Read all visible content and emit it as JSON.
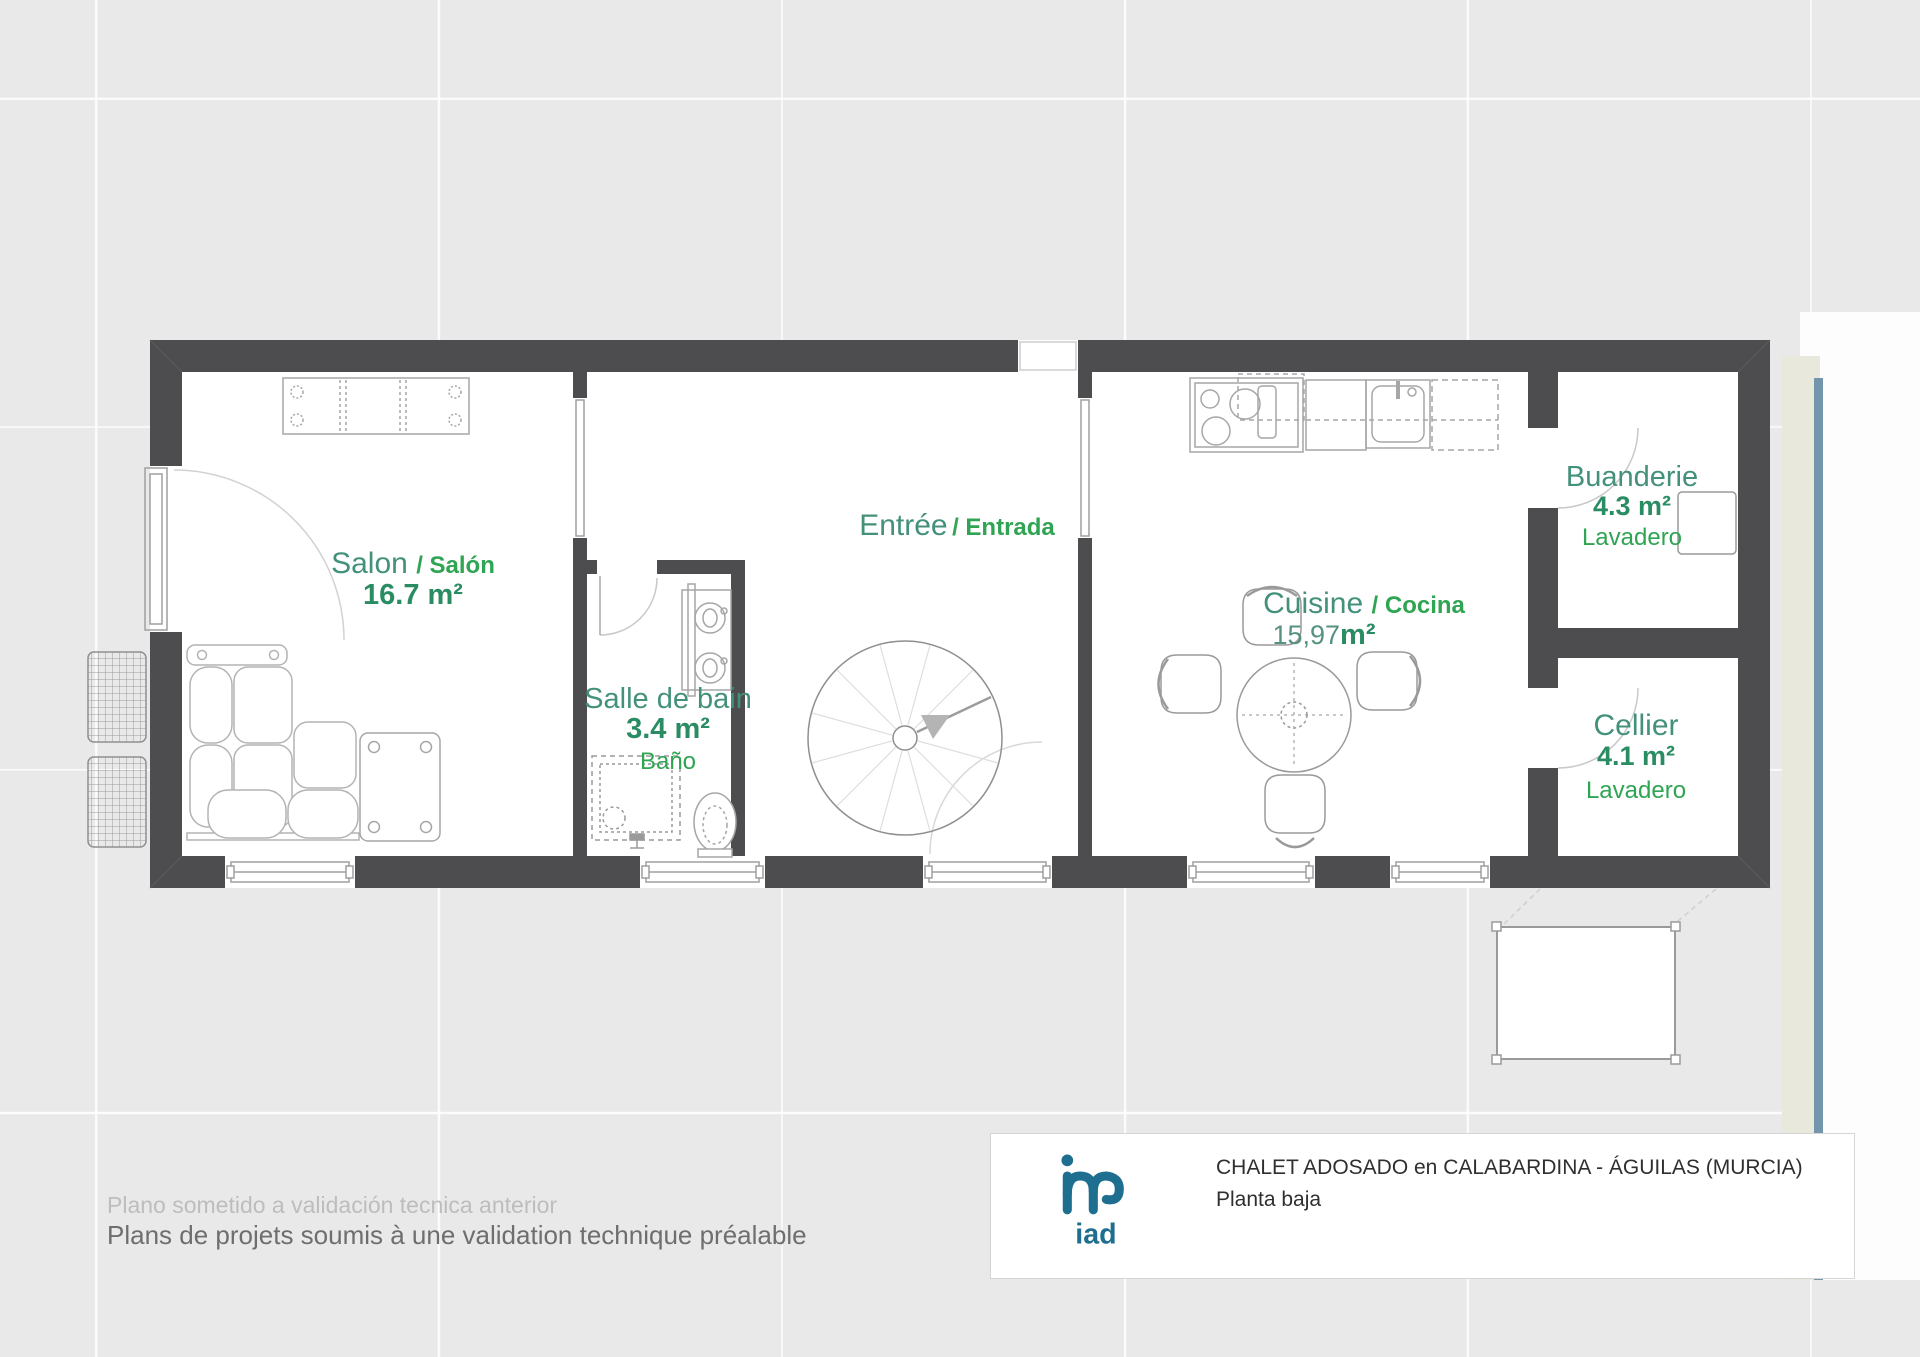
{
  "colors": {
    "wall": "#4d4d4f",
    "background": "#e9e9e9",
    "room_name": "#44917b",
    "room_name_alt": "#2fa452",
    "room_area": "#2a8c62",
    "logo_teal": "#1e6e90",
    "sheet_cream": "#e9e8dc",
    "pool_edge_blue": "#7396ad"
  },
  "plan": {
    "rooms": {
      "salon": {
        "name": "Salon",
        "name_alt": "/ Salón",
        "area": "16.7 m²"
      },
      "salle_de_bain": {
        "name": "Salle de bain",
        "name_alt": "Baño",
        "area": "3.4 m²"
      },
      "entree": {
        "name": "Entrée",
        "name_alt": "/ Entrada"
      },
      "cuisine": {
        "name": "Cuisine",
        "name_alt": "/ Cocina",
        "area_value": "15,97",
        "area_unit": "m²"
      },
      "buanderie": {
        "name": "Buanderie",
        "name_alt": "Lavadero",
        "area": "4.3 m²"
      },
      "cellier": {
        "name": "Cellier",
        "name_alt": "Lavadero",
        "area": "4.1 m²"
      }
    }
  },
  "title_block": {
    "logo_text": "iad",
    "title": "CHALET ADOSADO en CALABARDINA - ÁGUILAS (MURCIA)",
    "subtitle": "Planta baja"
  },
  "footer": {
    "line1": "Plano sometido a validación tecnica anterior",
    "line2": "Plans de projets soumis à une validation technique préalable"
  }
}
